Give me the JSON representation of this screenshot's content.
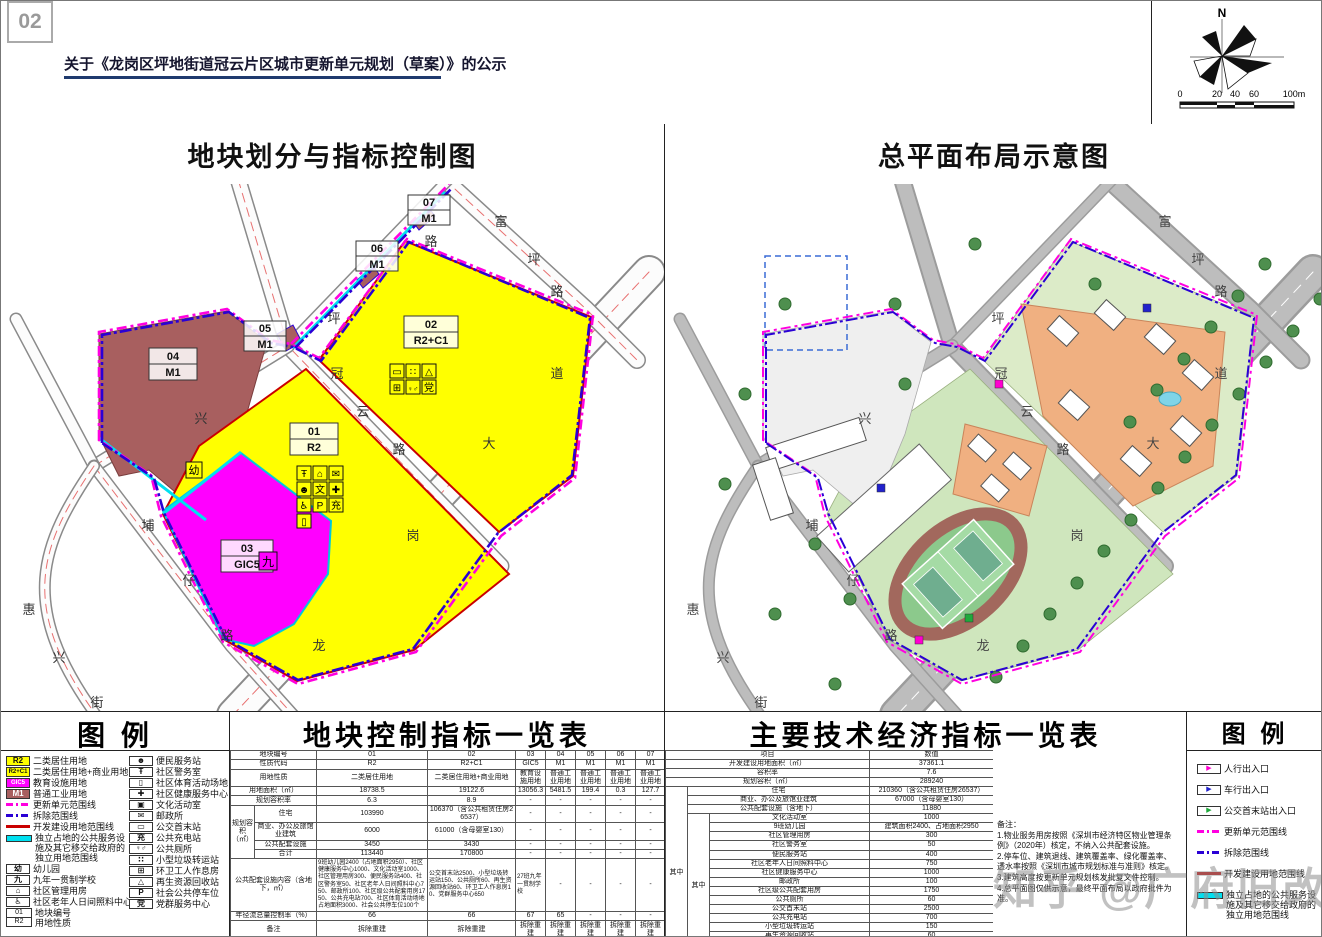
{
  "header": {
    "page_number": "02",
    "title": "关于《龙岗区坪地街道冠云片区城市更新单元规划（草案）》的公示"
  },
  "compass": {
    "north": "N",
    "ticks": [
      "0",
      "20",
      "40",
      "60",
      "100m"
    ]
  },
  "panels": {
    "left_title": "地块划分与指标控制图",
    "right_title": "总平面布局示意图"
  },
  "maps": {
    "parcels": [
      {
        "c": "01",
        "t": "R2"
      },
      {
        "c": "02",
        "t": "R2+C1"
      },
      {
        "c": "03",
        "t": "GIC5"
      },
      {
        "c": "04",
        "t": "M1"
      },
      {
        "c": "05",
        "t": "M1"
      },
      {
        "c": "06",
        "t": "M1"
      },
      {
        "c": "07",
        "t": "M1"
      }
    ],
    "roads": {
      "fu": [
        "富",
        "坪",
        "路"
      ],
      "gy": [
        "坪",
        "冠",
        "云",
        "路"
      ],
      "lg": [
        "龙",
        "岗",
        "大",
        "道"
      ],
      "pz": [
        "埔",
        "仔",
        "路"
      ],
      "hx": [
        "惠",
        "兴",
        "街"
      ],
      "xing": "兴",
      "lu": "路"
    },
    "icons": {
      "kinder": "幼",
      "school": "九",
      "police": "Ŧ",
      "mgmt": "⌂",
      "post": "✉",
      "conven": "☻",
      "culture": "文",
      "health": "✚",
      "elder": "♿",
      "park": "P",
      "charge": "充",
      "sport": "▯",
      "bus": "▭",
      "waste": "∷",
      "recycle": "△",
      "sanit": "⊞",
      "toilet": "♀♂",
      "party": "党"
    },
    "colors": {
      "residential": "#ffff00",
      "education": "#ff00ff",
      "industrial": "#a85f5f",
      "update_line": "#ff00e0",
      "demolish_line": "#2a00d5",
      "develop_line": "#c90000",
      "independent_line": "#00e0f0"
    }
  },
  "legend_left": {
    "title": "图  例",
    "col1": [
      {
        "code": "R2",
        "label": "二类居住用地"
      },
      {
        "code": "R2+C1",
        "label": "二类居住用地+商业用地"
      },
      {
        "code": "GIC5",
        "label": "教育设施用地"
      },
      {
        "code": "M1",
        "label": "普通工业用地"
      },
      {
        "label": "更新单元范围线"
      },
      {
        "label": "拆除范围线"
      },
      {
        "label": "开发建设用地范围线"
      },
      {
        "label": "独立占地的公共服务设施及其它移交给政府的独立用地范围线"
      },
      {
        "glyph": "幼",
        "label": "幼儿园"
      },
      {
        "glyph": "九",
        "label": "九年一贯制学校"
      },
      {
        "glyph": "⌂",
        "label": "社区管理用房"
      },
      {
        "glyph": "♿",
        "label": "社区老年人日间照料中心"
      },
      {
        "code1": "01",
        "code2": "R2",
        "label1": "地块编号",
        "label2": "用地性质"
      }
    ],
    "col2": [
      {
        "glyph": "☻",
        "label": "便民服务站"
      },
      {
        "glyph": "Ŧ",
        "label": "社区警务室"
      },
      {
        "glyph": "▯",
        "label": "社区体育活动场地"
      },
      {
        "glyph": "✚",
        "label": "社区健康服务中心"
      },
      {
        "glyph": "▣",
        "label": "文化活动室"
      },
      {
        "glyph": "✉",
        "label": "邮政所"
      },
      {
        "glyph": "▭",
        "label": "公交首末站"
      },
      {
        "glyph": "充",
        "label": "公共充电站"
      },
      {
        "glyph": "♀♂",
        "label": "公共厕所"
      },
      {
        "glyph": "∷",
        "label": "小型垃圾转运站"
      },
      {
        "glyph": "⊞",
        "label": "环卫工人作息房"
      },
      {
        "glyph": "△",
        "label": "再生资源回收站"
      },
      {
        "glyph": "P",
        "label": "社会公共停车位"
      },
      {
        "glyph": "党",
        "label": "党群服务中心"
      }
    ]
  },
  "legend_right": {
    "title": "图  例",
    "items": [
      {
        "glyph": "▶",
        "color": "#ff00d0",
        "label": "人行出入口"
      },
      {
        "glyph": "▶",
        "color": "#2222cc",
        "label": "车行出入口"
      },
      {
        "glyph": "▶",
        "color": "#1faa3c",
        "label": "公交首末站出入口"
      },
      {
        "label": "更新单元范围线"
      },
      {
        "label": "拆除范围线"
      },
      {
        "label": "开发建设用地范围线"
      },
      {
        "label": "独立占地的公共服务设施及其它移交给政府的独立用地范围线"
      }
    ]
  },
  "mid_table": {
    "title": "地块控制指标一览表",
    "labels": {
      "no": "地块编号",
      "code": "性质代码",
      "use": "用地性质",
      "area": "用地面积（㎡）",
      "far": "规划容积率",
      "vol": "规划容积（㎡）",
      "res": "住宅",
      "com": "商业、办公及旅馆业建筑",
      "pub": "公共配套设施",
      "sum": "合计",
      "fac": "公共配套设施内容（含地下，㎡）",
      "runoff": "年径流总量控制率（%）",
      "remark": "备注"
    },
    "cols": [
      {
        "no": "01",
        "code": "R2",
        "use": "二类居住用地",
        "area": "18738.5",
        "far": "6.3",
        "res": "103990",
        "com": "6000",
        "pub": "3450",
        "sum": "113440",
        "fac": "9班幼儿园2400（占地面积2950）、社区健康服务中心1000、文化活动室1000、社区管理用房300、便民服务站400、社区警务室50、社区老年人日间照料中心750、邮政所100、社区级公共配套用房1750、公共充电站700、社区体育活动场地占地面积3000、社会公共停车位100个",
        "runoff": "66",
        "remark": "拆除重建"
      },
      {
        "no": "02",
        "code": "R2+C1",
        "use": "二类居住用地+商业用地",
        "area": "19122.6",
        "far": "8.9",
        "res": "106370（含公共租赁住房26537）",
        "com": "61000（含母婴室130）",
        "pub": "3430",
        "sum": "170800",
        "fac": "公交首末站2500、小型垃圾转运站150、公共厕所60、再生资源回收站60、环卫工人作息房10、党群服务中心650",
        "runoff": "66",
        "remark": "拆除重建"
      },
      {
        "no": "03",
        "code": "GIC5",
        "use": "教育设施用地",
        "area": "13056.3",
        "far": "-",
        "res": "-",
        "com": "-",
        "pub": "-",
        "sum": "-",
        "fac": "27班九年一贯制学校",
        "runoff": "67",
        "remark": "拆除重建"
      },
      {
        "no": "04",
        "code": "M1",
        "use": "普通工业用地",
        "area": "5481.5",
        "far": "-",
        "res": "-",
        "com": "-",
        "pub": "-",
        "sum": "-",
        "fac": "-",
        "runoff": "65",
        "remark": "拆除重建"
      },
      {
        "no": "05",
        "code": "M1",
        "use": "普通工业用地",
        "area": "199.4",
        "far": "-",
        "res": "-",
        "com": "-",
        "pub": "-",
        "sum": "-",
        "fac": "-",
        "runoff": "-",
        "remark": "拆除重建"
      },
      {
        "no": "06",
        "code": "M1",
        "use": "普通工业用地",
        "area": "0.3",
        "far": "-",
        "res": "-",
        "com": "-",
        "pub": "-",
        "sum": "-",
        "fac": "-",
        "runoff": "-",
        "remark": "拆除重建"
      },
      {
        "no": "07",
        "code": "M1",
        "use": "普通工业用地",
        "area": "127.7",
        "far": "-",
        "res": "-",
        "com": "-",
        "pub": "-",
        "sum": "-",
        "fac": "-",
        "runoff": "-",
        "remark": "拆除重建"
      }
    ]
  },
  "right_table": {
    "title": "主要技术经济指标一览表",
    "header": {
      "item": "项目",
      "value": "数值"
    },
    "zhong": "其中",
    "rows": [
      {
        "l": "开发建设用地面积（㎡）",
        "v": "37361.1"
      },
      {
        "l": "容积率",
        "v": "7.6"
      },
      {
        "l": "规划容积（㎡）",
        "v": "289240"
      },
      {
        "l": "住宅",
        "v": "210360（含公共租赁住房26537）"
      },
      {
        "l": "商业、办公及旅馆业建筑",
        "v": "67000（含母婴室130）"
      },
      {
        "l": "公共配套设施（含地下）",
        "v": "11880"
      },
      {
        "l": "文化活动室",
        "v": "1000"
      },
      {
        "l": "9班幼儿园",
        "v": "建筑面积2400、占地面积2950"
      },
      {
        "l": "社区管理用房",
        "v": "300"
      },
      {
        "l": "社区警务室",
        "v": "50"
      },
      {
        "l": "便民服务站",
        "v": "400"
      },
      {
        "l": "社区老年人日间照料中心",
        "v": "750"
      },
      {
        "l": "社区健康服务中心",
        "v": "1000"
      },
      {
        "l": "邮政所",
        "v": "100"
      },
      {
        "l": "社区级公共配套用房",
        "v": "1750"
      },
      {
        "l": "公共厕所",
        "v": "60"
      },
      {
        "l": "公交首末站",
        "v": "2500"
      },
      {
        "l": "公共充电站",
        "v": "700"
      },
      {
        "l": "小型垃圾转运站",
        "v": "150"
      },
      {
        "l": "再生资源回收站",
        "v": "60"
      },
      {
        "l": "环卫工人作息房",
        "v": "10"
      },
      {
        "l": "党群服务中心",
        "v": "650"
      },
      {
        "l": "社区体育活动场地",
        "v": "占地面积3000"
      },
      {
        "l": "社会公共停车位",
        "v": "100个"
      }
    ],
    "notes_title": "备注：",
    "notes": [
      "1.物业服务用房按照《深圳市经济特区物业管理条例》（2020年）核定，不纳入公共配套设施。",
      "2.停车位、建筑退线、建筑覆盖率、绿化覆盖率、透水率按照《深圳市城市规划标准与准则》核定。",
      "3.建筑高度按更新单元规划核发批复文件控制。",
      "4.总平面图仅供示意，最终平面布局以政府批件为准。"
    ]
  },
  "watermark": "知乎 @广府旧改"
}
